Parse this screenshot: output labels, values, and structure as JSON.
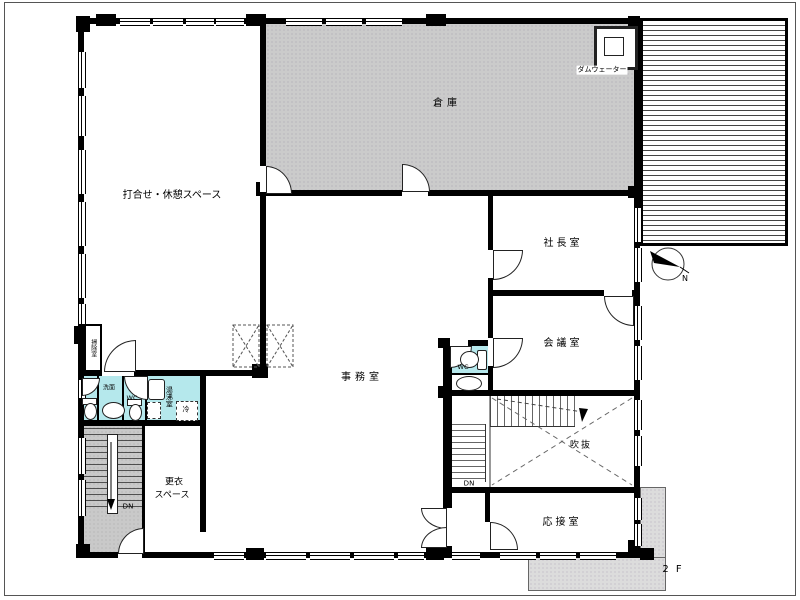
{
  "floor": {
    "label": "2 F"
  },
  "rooms": {
    "meeting_space": {
      "label": "打合せ・休憩スペース"
    },
    "warehouse": {
      "label": "倉庫"
    },
    "presidents_office": {
      "label": "社長室"
    },
    "conference_room": {
      "label": "会議室"
    },
    "office": {
      "label": "事務室"
    },
    "atrium": {
      "label": "吹抜"
    },
    "reception_room": {
      "label": "応接室"
    },
    "changing_space": {
      "line1": "更衣",
      "line2": "スペース"
    },
    "kitchenette": {
      "label": "湯沸室"
    },
    "washroom": {
      "label": "洗面"
    },
    "wc_left": {
      "label": "WC"
    },
    "wc_office": {
      "label": "WC"
    },
    "refrigerator": {
      "label": "冷"
    },
    "cleaning_room": {
      "label": "掃除室"
    },
    "dumbwaiter": {
      "label": "ダムウェーター"
    }
  },
  "stairs": {
    "left": {
      "direction_label": "DN"
    },
    "right": {
      "direction_label": "DN"
    }
  },
  "compass": {
    "label": "N"
  },
  "colors": {
    "wall": "#000000",
    "warehouse_fill": "#cbcbcb",
    "wet_area_fill": "#b5e8ec",
    "stair_fill": "#c9c9c9",
    "balcony_fill": "#dcdcdc"
  }
}
